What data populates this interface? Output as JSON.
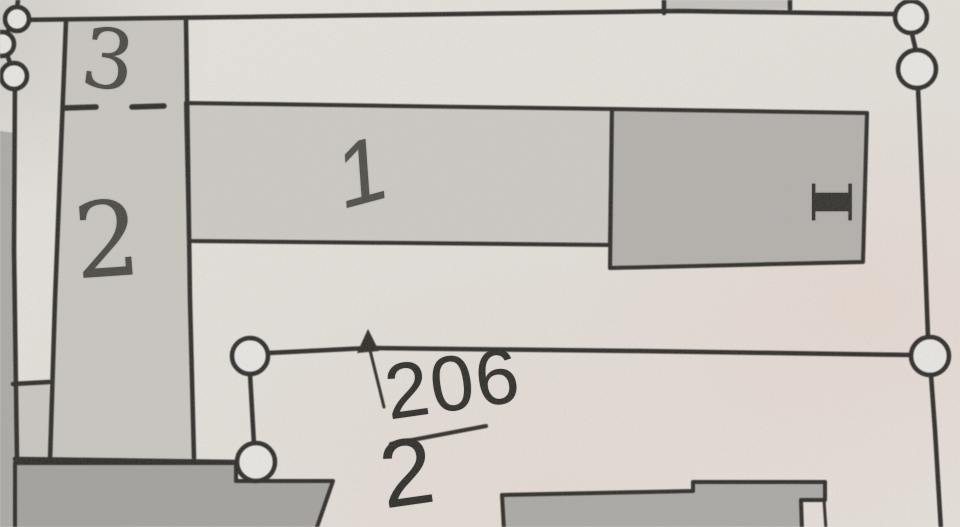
{
  "map": {
    "labels": {
      "parcel_top_left": "3",
      "parcel_left": "2",
      "house_number": "1",
      "storeys": "I",
      "parcel_number_numerator": "206",
      "parcel_number_denominator": "2"
    },
    "colors": {
      "paper": "#e5e1db",
      "line": "#2d2b28",
      "parcel_strip_fill": "#cac7c1",
      "building_light_fill": "#cdcac5",
      "building_medium_fill": "#b4b1ad",
      "building_bottom_left_fill": "#a3a29e",
      "building_bottom_right_fill": "#aaa9a5",
      "neighbor_building_fill": "#c6c3be",
      "left_margin_fill": "#acaaa6",
      "survey_point_fill": "#e9e7e3",
      "handwriting_ink": "#4a4842",
      "print_ink": "#2e2c28"
    }
  }
}
